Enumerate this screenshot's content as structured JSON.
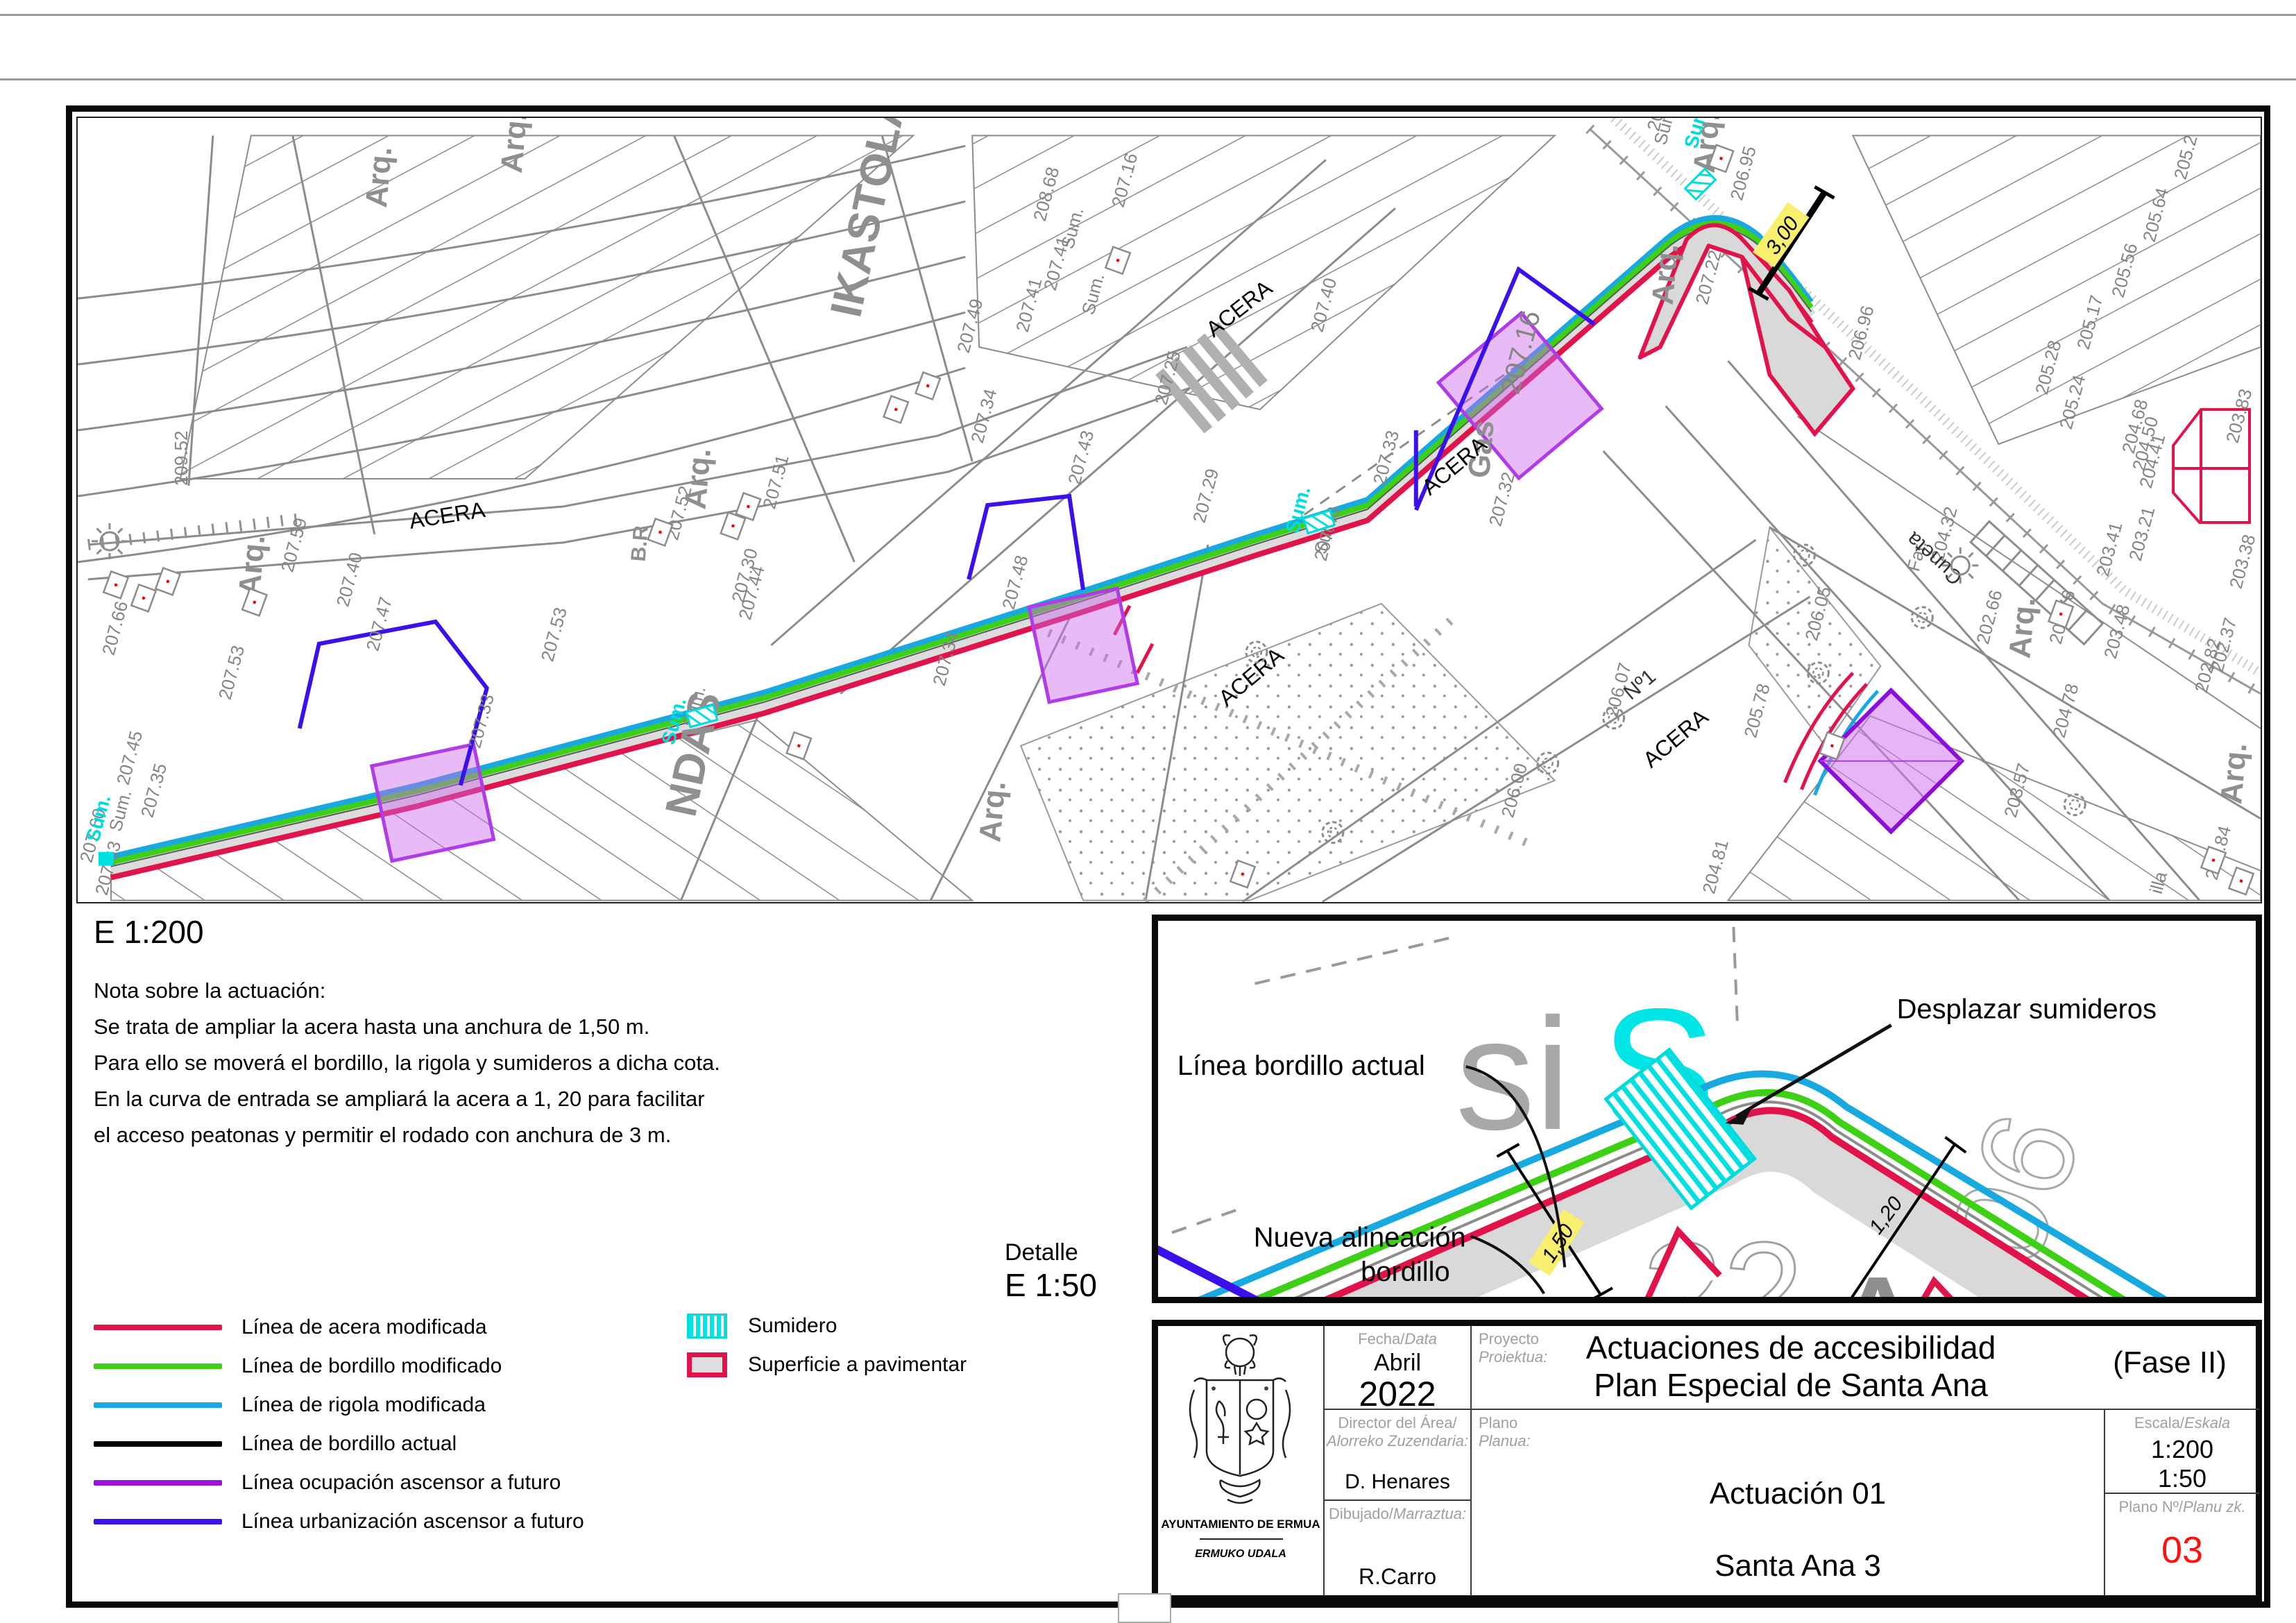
{
  "page": {
    "scale_main": "E 1:200",
    "detail_label": "Detalle",
    "detail_scale": "E 1:50"
  },
  "notes": {
    "title": "Nota sobre la actuación:",
    "lines": [
      "Se trata de ampliar la acera hasta una anchura de 1,50 m.",
      "Para ello se moverá el bordillo, la rigola y sumideros a dicha cota.",
      "En la curva de entrada se ampliará la acera a 1, 20 para facilitar",
      "el acceso peatonas y permitir el rodado con anchura de 3 m."
    ]
  },
  "legend": {
    "lines": [
      {
        "label": "Línea de acera modificada",
        "color": "#e0134a"
      },
      {
        "label": "Línea de bordillo modificado",
        "color": "#3ed015"
      },
      {
        "label": "Línea de rigola modificada",
        "color": "#17a9df"
      },
      {
        "label": "Línea de bordillo actual",
        "color": "#000000"
      },
      {
        "label": "Línea ocupación ascensor a futuro",
        "color": "#9a11e0"
      },
      {
        "label": "Línea urbanización ascensor a futuro",
        "color": "#3c10e9"
      }
    ],
    "swatches": [
      {
        "label": "Sumidero",
        "type": "sumidero"
      },
      {
        "label": "Superficie a pavimentar",
        "type": "pavimentar"
      }
    ]
  },
  "detail": {
    "labels": {
      "linea_actual": "Línea bordillo actual",
      "nueva_1": "Nueva alineación",
      "nueva_2": "bordillo",
      "desplazar": "Desplazar sumideros",
      "dim_150": "1,50",
      "dim_120": "1,20"
    },
    "ghost": {
      "si": "si",
      "s": "S",
      "n22": "22",
      "n06": "06",
      "a": "A"
    }
  },
  "map": {
    "dim_300": "3,00",
    "street_labels": [
      [
        "ACERA",
        480,
        592,
        -9
      ],
      [
        "ACERA",
        1638,
        317,
        -38
      ],
      [
        "ACERA",
        1950,
        545,
        -40
      ],
      [
        "ACERA",
        1657,
        849,
        -40
      ],
      [
        "ACERA",
        2269,
        938,
        -40
      ]
    ],
    "big_labels": [
      [
        "IKASTOLA",
        1128,
        290,
        -78
      ],
      [
        "NDAS",
        890,
        1010,
        -78
      ]
    ],
    "area_labels": [
      [
        "Cuneta",
        2720,
        660,
        222
      ],
      [
        "Nº1",
        2240,
        840,
        -40
      ]
    ],
    "arq_labels": [
      [
        "Arq.",
        262,
        690
      ],
      [
        "Arq.",
        445,
        130
      ],
      [
        "Arq.",
        640,
        80
      ],
      [
        "Arq.",
        905,
        565
      ],
      [
        "Arq.",
        1330,
        1045
      ],
      [
        "Arq.",
        2360,
        80
      ],
      [
        "Arq.",
        2300,
        270
      ],
      [
        "Arq.",
        2815,
        780
      ],
      [
        "Arq.",
        3120,
        990
      ],
      [
        "Gas",
        2035,
        520
      ],
      [
        "B.R",
        818,
        640,
        30
      ]
    ],
    "elev_labels": [
      [
        "209.52",
        158,
        530,
        -90
      ],
      [
        "207.59",
        310,
        656
      ],
      [
        "207.40",
        390,
        706
      ],
      [
        "207.47",
        433,
        770
      ],
      [
        "207.66",
        52,
        776
      ],
      [
        "207.53",
        685,
        785
      ],
      [
        "207.44",
        970,
        725
      ],
      [
        "207.48",
        1350,
        710
      ],
      [
        "207.34",
        1250,
        820
      ],
      [
        "207.33",
        580,
        910
      ],
      [
        "207.45",
        73,
        963
      ],
      [
        "207.35",
        108,
        1010
      ],
      [
        "207.60",
        20,
        1075
      ],
      [
        "207.63",
        42,
        1122
      ],
      [
        "207.53",
        220,
        840
      ],
      [
        "208.68",
        1395,
        150
      ],
      [
        "207.16",
        1508,
        130
      ],
      [
        "207.41",
        1410,
        250
      ],
      [
        "207.41",
        1370,
        310
      ],
      [
        "207.49",
        1285,
        340
      ],
      [
        "207.34",
        1305,
        470
      ],
      [
        "207.43",
        1445,
        530
      ],
      [
        "207.25",
        1570,
        415
      ],
      [
        "207.40",
        1795,
        310
      ],
      [
        "207.52",
        865,
        610
      ],
      [
        "207.30",
        960,
        700
      ],
      [
        "207.51",
        1005,
        565
      ],
      [
        "207.29",
        1625,
        585
      ],
      [
        "207.33",
        1885,
        530
      ],
      [
        "207.40",
        1800,
        640
      ],
      [
        "206.95",
        2400,
        120
      ],
      [
        "206.93",
        2280,
        20
      ],
      [
        "207.22",
        2350,
        270
      ],
      [
        "207.32",
        2052,
        590
      ],
      [
        "205.2",
        3040,
        90
      ],
      [
        "205.64",
        2995,
        180
      ],
      [
        "205.56",
        2950,
        260
      ],
      [
        "205.17",
        2900,
        335
      ],
      [
        "205.28",
        2840,
        400
      ],
      [
        "205.24",
        2875,
        450
      ],
      [
        "203.83",
        3115,
        470
      ],
      [
        "203.21",
        2975,
        640
      ],
      [
        "203.38",
        3120,
        680
      ],
      [
        "204.68",
        2965,
        485
      ],
      [
        "204.50",
        2980,
        510
      ],
      [
        "204.41",
        2990,
        535
      ],
      [
        "203.48",
        2939,
        781
      ],
      [
        "202.82",
        3070,
        830
      ],
      [
        "202.66",
        2755,
        760
      ],
      [
        "202.76",
        2860,
        760
      ],
      [
        "202.37",
        3093,
        800
      ],
      [
        "206.07",
        2220,
        865
      ],
      [
        "206.00",
        2070,
        1010
      ],
      [
        "206.05",
        2508,
        755
      ],
      [
        "205.78",
        2420,
        895
      ],
      [
        "204.81",
        2360,
        1120
      ],
      [
        "203.57",
        2795,
        1010
      ],
      [
        "204.78",
        2865,
        895
      ],
      [
        "206.96",
        2570,
        350
      ],
      [
        "203.41",
        2928,
        662
      ],
      [
        "204.32",
        2690,
        640
      ],
      [
        "201.84",
        3085,
        1100
      ],
      [
        "Far.",
        2655,
        655
      ],
      [
        "illa",
        3005,
        1120
      ],
      [
        "Sum.",
        1435,
        190
      ],
      [
        "Sum.",
        1465,
        285
      ],
      [
        "Sum.",
        62,
        1030
      ],
      [
        "Sum.",
        890,
        880
      ],
      [
        "Sum.",
        2290,
        40
      ],
      [
        "Sum.",
        1800,
        630
      ],
      [
        "207.16",
        2078,
        400,
        -75,
        40
      ]
    ],
    "sum_cyan": [
      [
        30,
        1045
      ],
      [
        860,
        905
      ],
      [
        1760,
        600
      ],
      [
        2335,
        45
      ]
    ],
    "markers": [
      [
        55,
        673
      ],
      [
        95,
        692
      ],
      [
        130,
        668
      ],
      [
        255,
        698
      ],
      [
        840,
        597
      ],
      [
        945,
        588
      ],
      [
        967,
        560
      ],
      [
        1180,
        420
      ],
      [
        1226,
        386
      ],
      [
        1500,
        205
      ],
      [
        2370,
        58
      ],
      [
        2860,
        715
      ],
      [
        3080,
        1070
      ],
      [
        3120,
        1100
      ],
      [
        1040,
        905
      ],
      [
        1680,
        1090
      ],
      [
        2530,
        905
      ]
    ],
    "roses": [
      [
        1700,
        770
      ],
      [
        1810,
        1030
      ],
      [
        2120,
        930
      ],
      [
        2215,
        865
      ],
      [
        2490,
        630
      ],
      [
        2510,
        800
      ],
      [
        2660,
        720
      ],
      [
        2880,
        990
      ]
    ],
    "suns": [
      [
        46,
        610
      ],
      [
        2715,
        645
      ]
    ],
    "sumideros": [
      [
        900,
        862,
        -15
      ],
      [
        1790,
        582,
        -17
      ],
      [
        2340,
        95,
        -45
      ]
    ]
  },
  "title_block": {
    "org": {
      "line1": "AYUNTAMIENTO DE ERMUA",
      "line2": "ERMUKO UDALA"
    },
    "fecha": {
      "label": "Fecha/",
      "label_it": "Data",
      "month": "Abril",
      "year": "2022"
    },
    "proyecto": {
      "label": "Proyecto",
      "label_it": "Proiektua:",
      "line1": "Actuaciones de accesibilidad",
      "line2": "Plan Especial de Santa Ana",
      "fase": "(Fase II)"
    },
    "director": {
      "label": "Director del Área/",
      "label_it": "Alorreko Zuzendaria:",
      "value": "D. Henares"
    },
    "plano": {
      "label": "Plano",
      "label_it": "Planua:",
      "line1": "Actuación 01",
      "line2": "Santa Ana 3"
    },
    "dibujado": {
      "label": "Dibujado/",
      "label_it": "Marraztua:",
      "value": "R.Carro"
    },
    "escala": {
      "label": "Escala/",
      "label_it": "Eskala",
      "v1": "1:200",
      "v2": "1:50"
    },
    "plano_num": {
      "label": "Plano Nº/",
      "label_it": "Planu zk.",
      "value": "03"
    }
  },
  "colors": {
    "acera": "#e0134a",
    "bordillo": "#3ed015",
    "rigola": "#17a9df",
    "ocupacion": "#9a11e0",
    "urbanizacion": "#3c10e9",
    "sumidero": "#00e0e0",
    "paved": "#d9d9d9",
    "plano_num": "#ff1010",
    "dim_bg": "#f8ef6e"
  }
}
